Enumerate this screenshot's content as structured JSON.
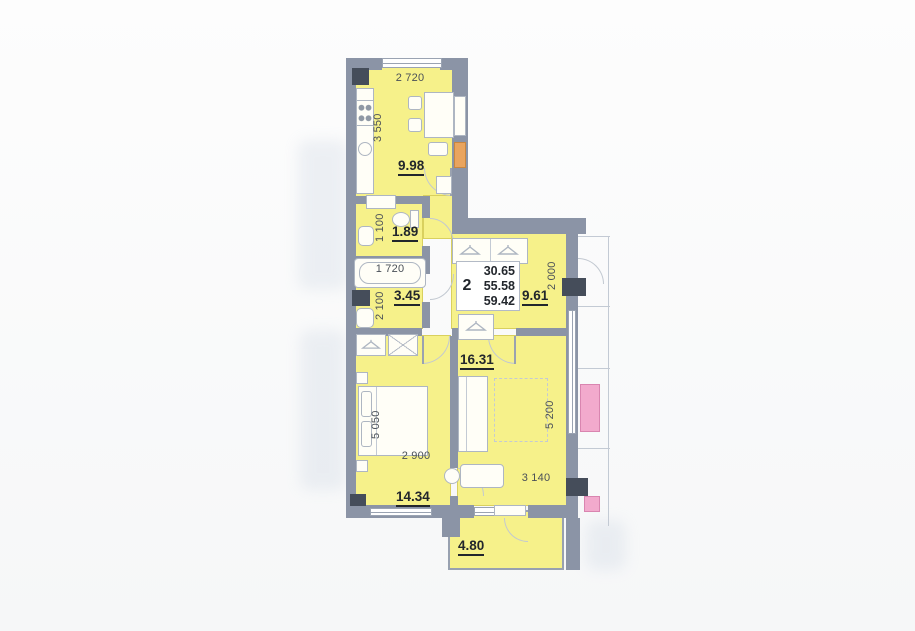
{
  "info": {
    "rooms_count": "2",
    "areas": [
      "30.65",
      "55.58",
      "59.42"
    ]
  },
  "labels": {
    "kitchen_area": "9.98",
    "kitchen_w": "2 720",
    "kitchen_h": "3 550",
    "wc_area": "1.89",
    "wc_h": "1 100",
    "bath_area": "3.45",
    "bath_w": "1 720",
    "bath_h": "2 100",
    "hall_area": "9.61",
    "hall_h": "2 000",
    "bedroom_area": "14.34",
    "bedroom_w": "2 900",
    "bedroom_h": "5 050",
    "living_area": "16.31",
    "living_w": "3 140",
    "living_h": "5 200",
    "balcony_area": "4.80"
  },
  "colors": {
    "room_fill": "#f6f18a",
    "wall": "#8b94a6",
    "wall_dark": "#454d5a",
    "accent_pink": "#f2aacd",
    "accent_orange": "#e9a45e"
  },
  "icons": {
    "hanger": "hanger-icon",
    "crossed_box": "crossed-box-icon"
  }
}
